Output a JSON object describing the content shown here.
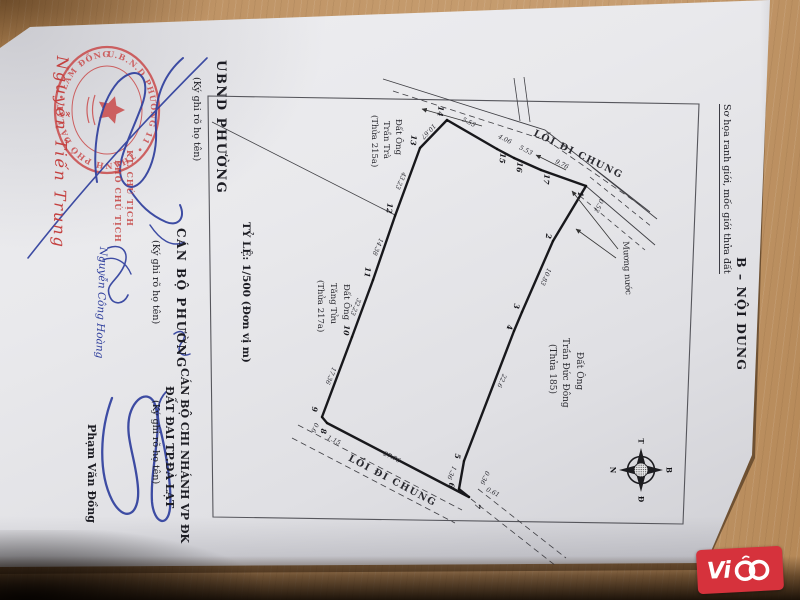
{
  "scene": {
    "wood_color": "#c49a6c",
    "paper_color": "#e9e9ec",
    "ink_blue": "#2f3f9d",
    "stamp_red": "#c94545",
    "logo_red": "#d6323c"
  },
  "signature_block": {
    "ubnd": {
      "title": "UBND PHƯỜNG",
      "note": "(Ký ghi rõ họ tên)",
      "stamp_role_line1": "KT. CHỦ TỊCH",
      "stamp_role_line2": "PHÓ CHỦ TỊCH",
      "signer": "Nguyễn Tiến Trung",
      "seal_ring_text": "U.B.N.D PHƯỜNG 11 • THÀNH PHỐ ĐÀ LẠT • LÂM ĐỒNG"
    },
    "scale_note": "TỶ LỆ: 1/500 (Đơn vị m)",
    "can_bo_phuong": {
      "title": "CÁN BỘ PHƯỜNG",
      "note": "(Ký ghi rõ họ tên)",
      "signer": "Nguyễn Công Hoàng"
    },
    "chi_nhanh": {
      "title1": "CÁN BỘ CHI NHÁNH VP ĐK",
      "title2": "ĐẤT ĐAI TP.ĐÀ LẠT",
      "note": "(Ký ghi rõ họ tên)",
      "signer": "Phạm Văn Đồng"
    }
  },
  "content": {
    "heading": "B – NỘI DUNG",
    "subheading": "Sơ họa ranh giới, mốc giới thửa đất"
  },
  "map": {
    "road_top": "LỐI ĐI CHUNG",
    "road_bottom": "LỐI ĐI CHUNG",
    "water": "Mương nước",
    "parcel_left_top": [
      "Đất Ông",
      "Trần Trà",
      "(Thửa 215a)"
    ],
    "parcel_left_bottom": [
      "Đất Ông",
      "Tăng Tửu",
      "(Thửa 217a)"
    ],
    "parcel_right": [
      "Đất Ông",
      "Trần Đức Đông",
      "(Thửa 185)"
    ],
    "compass": {
      "north": "B",
      "south": "N",
      "east": "Đ",
      "west": "T"
    },
    "points": [
      {
        "n": "1",
        "x": 586,
        "y": 186,
        "lx": 578,
        "ly": 194
      },
      {
        "n": "2",
        "x": 553,
        "y": 241,
        "lx": 546,
        "ly": 236
      },
      {
        "n": "3",
        "x": 522,
        "y": 312,
        "lx": 514,
        "ly": 306
      },
      {
        "n": "4",
        "x": 514,
        "y": 331,
        "lx": 507,
        "ly": 327
      },
      {
        "n": "5",
        "x": 464,
        "y": 461,
        "lx": 455,
        "ly": 456
      },
      {
        "n": "6",
        "x": 459,
        "y": 489,
        "lx": 449,
        "ly": 485
      },
      {
        "n": "7",
        "x": 469,
        "y": 497,
        "lx": 475,
        "ly": 506
      },
      {
        "n": "8",
        "x": 327,
        "y": 423,
        "lx": 321,
        "ly": 431
      },
      {
        "n": "9",
        "x": 322,
        "y": 417,
        "lx": 312,
        "ly": 409
      },
      {
        "n": "10",
        "x": 352,
        "y": 337,
        "lx": 344,
        "ly": 330
      },
      {
        "n": "11",
        "x": 373,
        "y": 280,
        "lx": 365,
        "ly": 272
      },
      {
        "n": "12",
        "x": 395,
        "y": 216,
        "lx": 387,
        "ly": 208
      },
      {
        "n": "13",
        "x": 420,
        "y": 148,
        "lx": 411,
        "ly": 140
      },
      {
        "n": "14",
        "x": 447,
        "y": 120,
        "lx": 438,
        "ly": 111
      },
      {
        "n": "15",
        "x": 497,
        "y": 149,
        "lx": 500,
        "ly": 158
      },
      {
        "n": "16",
        "x": 514,
        "y": 158,
        "lx": 517,
        "ly": 167
      },
      {
        "n": "17",
        "x": 541,
        "y": 170,
        "lx": 544,
        "ly": 179
      }
    ],
    "measurements": [
      {
        "v": "5.53",
        "x": 468,
        "y": 124,
        "a": 26
      },
      {
        "v": "4.06",
        "x": 504,
        "y": 141,
        "a": 26
      },
      {
        "v": "5.53",
        "x": 525,
        "y": 152,
        "a": 26
      },
      {
        "v": "9.76",
        "x": 561,
        "y": 166,
        "a": 26
      },
      {
        "v": "0.52",
        "x": 597,
        "y": 205,
        "a": 114
      },
      {
        "v": "10.83",
        "x": 544,
        "y": 276,
        "a": 114
      },
      {
        "v": "22.6",
        "x": 500,
        "y": 380,
        "a": 114
      },
      {
        "v": "0.36",
        "x": 483,
        "y": 477,
        "a": 114
      },
      {
        "v": "0.61",
        "x": 492,
        "y": 494,
        "a": 26
      },
      {
        "v": "1.36",
        "x": 450,
        "y": 472,
        "a": 114
      },
      {
        "v": "27.76",
        "x": 391,
        "y": 459,
        "a": 26
      },
      {
        "v": "1.15",
        "x": 333,
        "y": 442,
        "a": 26
      },
      {
        "v": "0.6",
        "x": 313,
        "y": 427,
        "a": 114
      },
      {
        "v": "17.36",
        "x": 329,
        "y": 375,
        "a": 113
      },
      {
        "v": "32.23",
        "x": 354,
        "y": 306,
        "a": 113
      },
      {
        "v": "14.38",
        "x": 376,
        "y": 246,
        "a": 113
      },
      {
        "v": "43.23",
        "x": 399,
        "y": 180,
        "a": 113
      },
      {
        "v": "10.67",
        "x": 427,
        "y": 130,
        "a": 134
      }
    ]
  },
  "watermark": {
    "text": "ViCO",
    "prefix": "Vi"
  }
}
